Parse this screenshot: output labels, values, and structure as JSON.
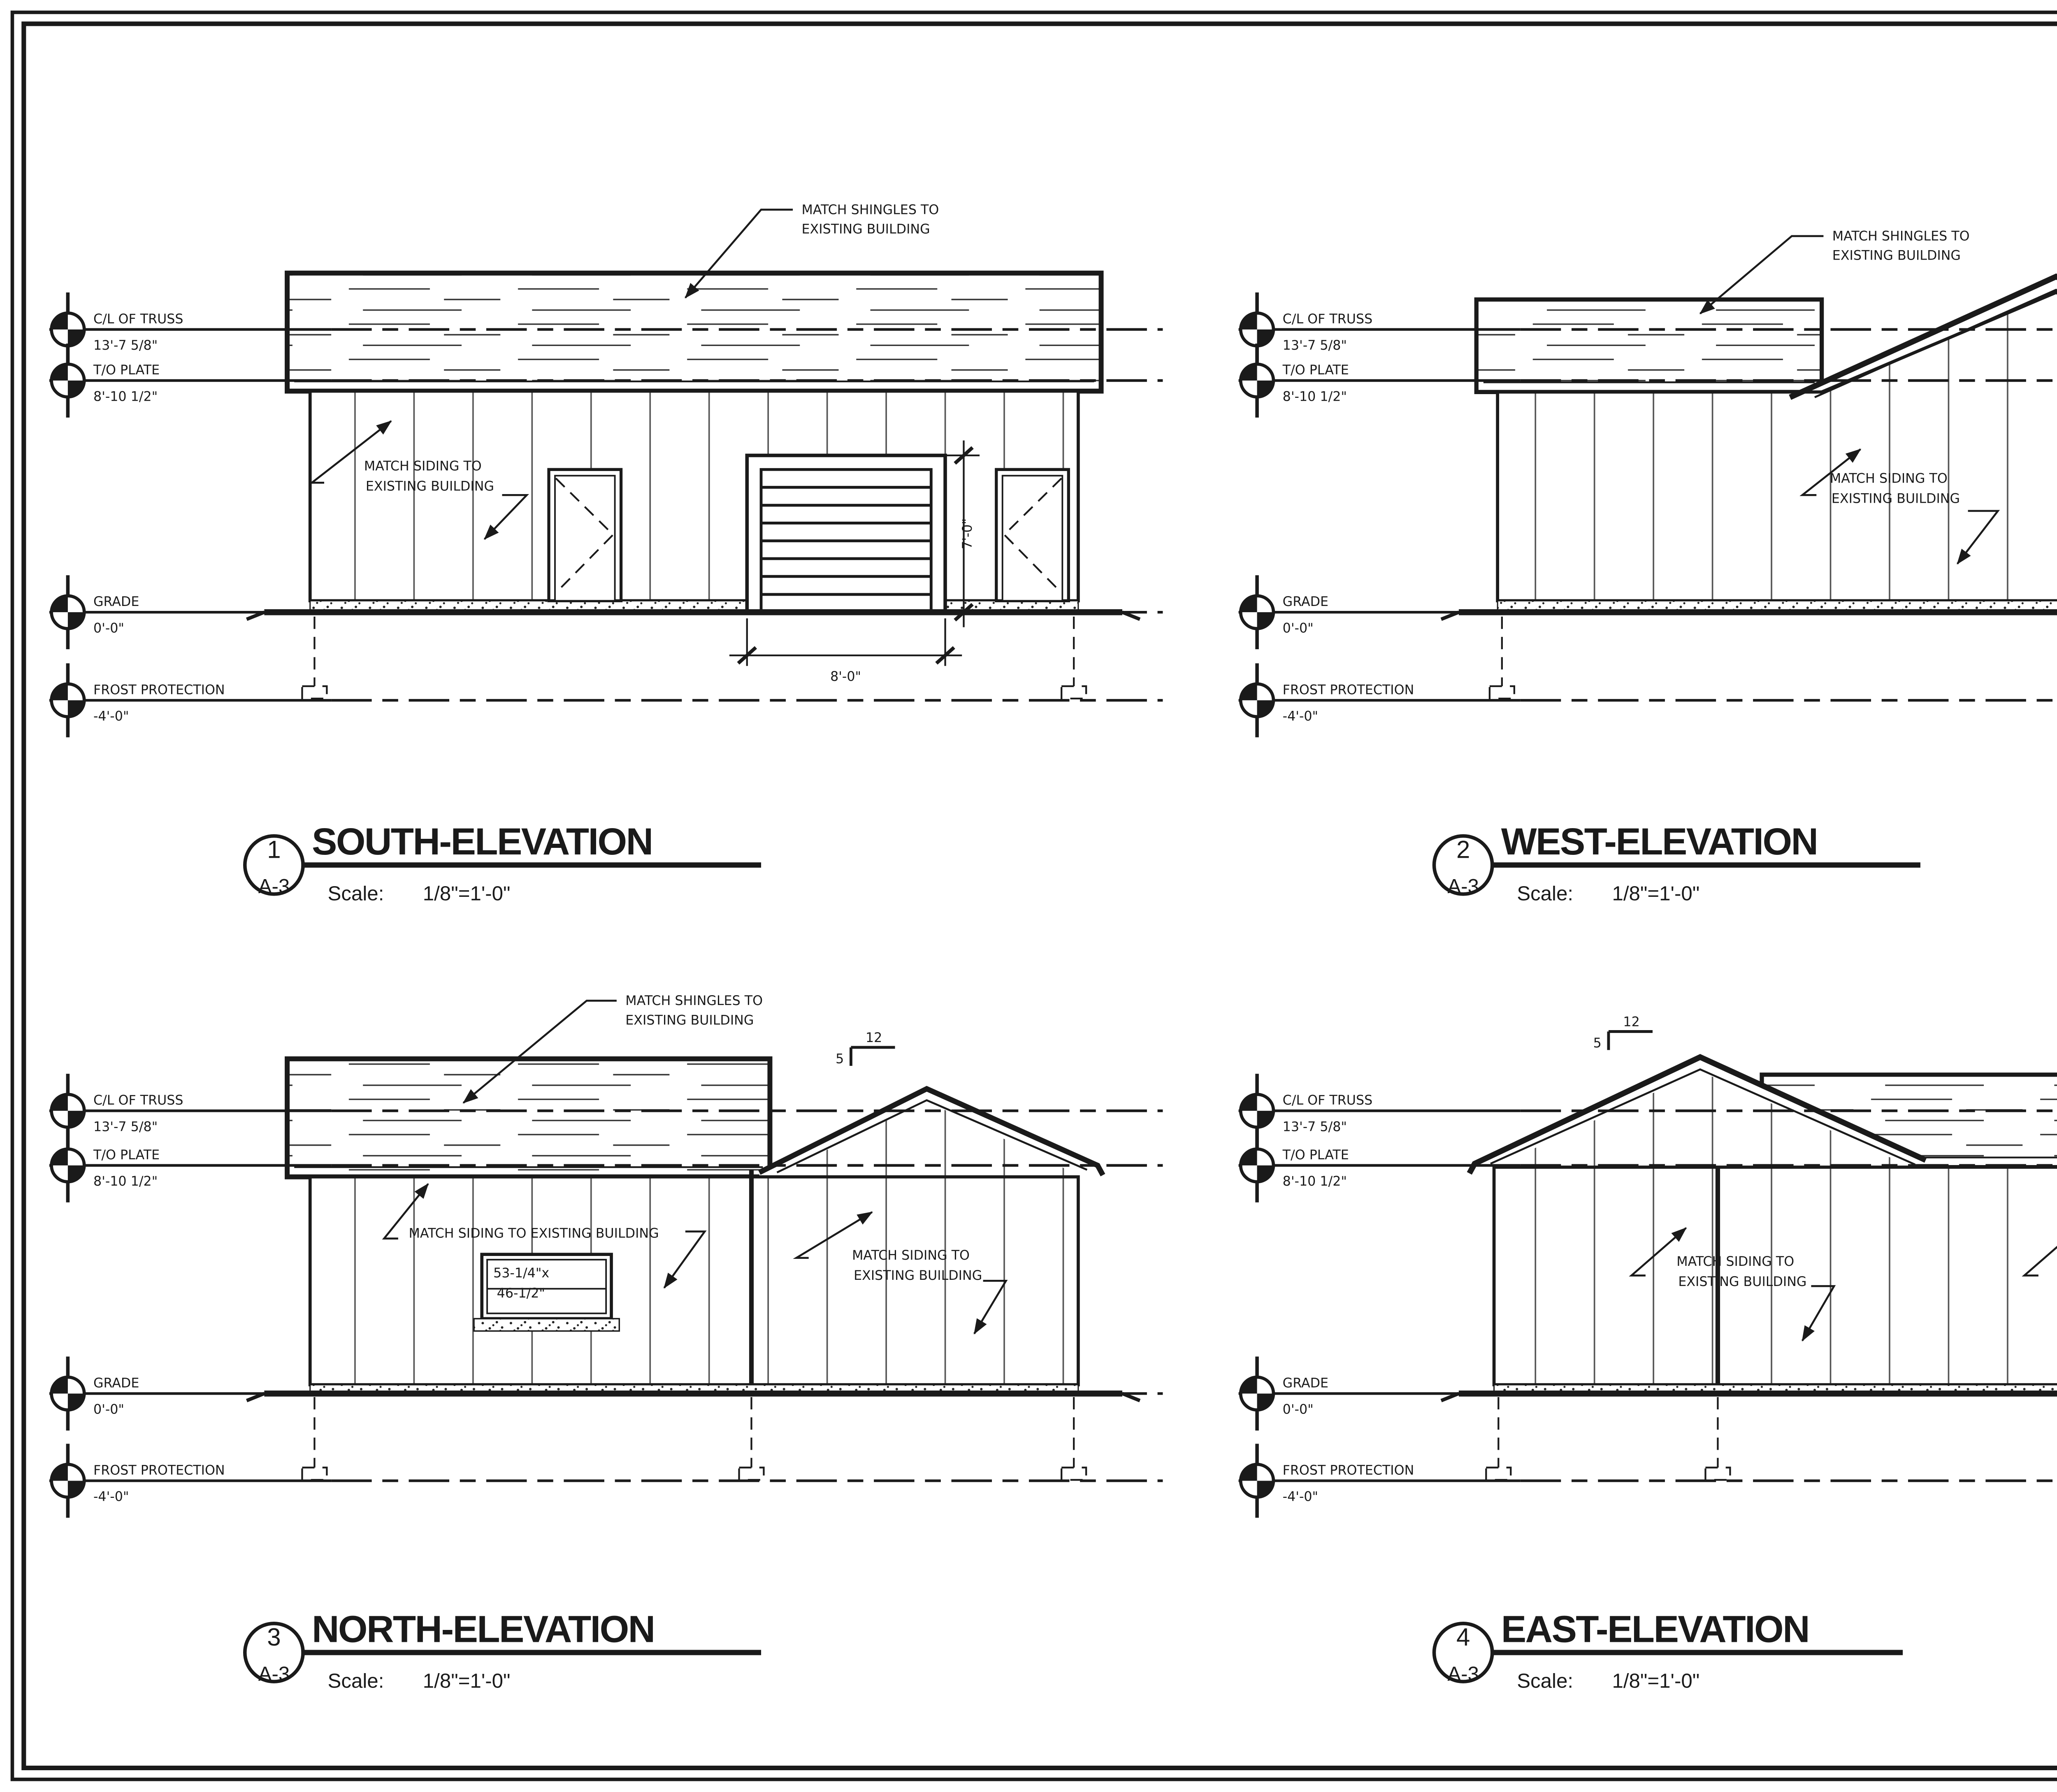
{
  "sheet": {
    "drawing_number": "A-3",
    "views": {
      "south": {
        "number": "1",
        "sheet_ref": "A-3",
        "title": "SOUTH-ELEVATION",
        "scale_label": "Scale:",
        "scale": "1/8\"=1'-0\""
      },
      "west": {
        "number": "2",
        "sheet_ref": "A-3",
        "title": "WEST-ELEVATION",
        "scale_label": "Scale:",
        "scale": "1/8\"=1'-0\""
      },
      "north": {
        "number": "3",
        "sheet_ref": "A-3",
        "title": "NORTH-ELEVATION",
        "scale_label": "Scale:",
        "scale": "1/8\"=1'-0\""
      },
      "east": {
        "number": "4",
        "sheet_ref": "A-3",
        "title": "EAST-ELEVATION",
        "scale_label": "Scale:",
        "scale": "1/8\"=1'-0\""
      }
    }
  },
  "datums": {
    "cl_truss": {
      "label": "C/L OF TRUSS",
      "value": "13'-7 5/8\""
    },
    "to_plate": {
      "label": "T/O PLATE",
      "value": "8'-10 1/2\""
    },
    "grade": {
      "label": "GRADE",
      "value": "0'-0\""
    },
    "frost": {
      "label": "FROST PROTECTION",
      "value": "-4'-0\""
    }
  },
  "annotations": {
    "match_shingles_l1": "MATCH SHINGLES TO",
    "match_shingles_l2": "EXISTING BUILDING",
    "match_siding_l1": "MATCH SIDING TO",
    "match_siding_l2": "EXISTING BUILDING",
    "match_siding_single": "MATCH SIDING TO EXISTING BUILDING",
    "garage_width": "8'-0\"",
    "garage_height": "7'-0\"",
    "window_size_l1": "53-1/4\"x",
    "window_size_l2": "46-1/2\"",
    "pitch_run": "12",
    "pitch_rise": "5"
  },
  "general_notes": {
    "title": "GENERAL NOTES:",
    "items": [
      [
        "CONTRACTOR TO VERIFY DIMENSIONS",
        "PRIOR TO CONSTRCTION"
      ],
      [
        "DESIGNER IS NOT LIABLE FOR ANY",
        "ERRORS OR OMISSIONS"
      ],
      [
        "DRAWINGS NOT TO BE SCALED"
      ],
      [
        "ALL CONSTRUCTION TO COMPLY WITH",
        "THE 2012 ONTARIO BUILDING CODE &",
        "LOCAL MUNICIPAL BYLAW"
      ],
      [
        "ALL DRAWINGS & RELATED DOCUMENTS",
        "ARE THE PROPERTY OF RAEZOR'S INC.",
        "& THE REPRODUCTION OF THESE",
        "DRAWINGS IN WHOLE OR IN PART IS",
        "FORBIDDEN WITHOUT RAEZOR'S INC.",
        "PERMISSION"
      ]
    ]
  },
  "revisions": {
    "header": {
      "no": "NO.",
      "desc": "REVISIONS",
      "date": "DATE"
    },
    "rows": [
      {
        "no": "02",
        "desc": "Permit",
        "date": "08/18/2023"
      },
      {
        "no": "01",
        "desc": "Truss Design",
        "date": "08/18/2023"
      }
    ]
  },
  "title_block": {
    "logo": {
      "name": "Raezor's Edge",
      "subtitle": "General Contractor",
      "accent_color": "#c63c35",
      "dark_color": "#47474a"
    },
    "company_name_l1": "Raezor's Edge",
    "company_name_l2": "General Contractor",
    "company_address": [
      "43 Ridewood Cres.",
      "St. Marys, On.",
      "N4X 1E8"
    ],
    "project_label": "PROJECT:",
    "project_lines": [
      "Raezor's Inc.",
      "Storage Building",
      "550 James St. S.",
      "St. Marys, ON."
    ],
    "drawing_title_label": "DRAWING TITLE:",
    "drawing_title": "1. Elevations",
    "drawn_by_label": "DRAWN BY:",
    "drawn_by": "AH",
    "scale_label": "SCALE:",
    "scale": "As Indicated",
    "checked_by_label": "CHECKED BY:",
    "checked_by": "DR",
    "drawing_number_label": "DRAWING NUMBER:",
    "drawing_number": "A-3"
  }
}
